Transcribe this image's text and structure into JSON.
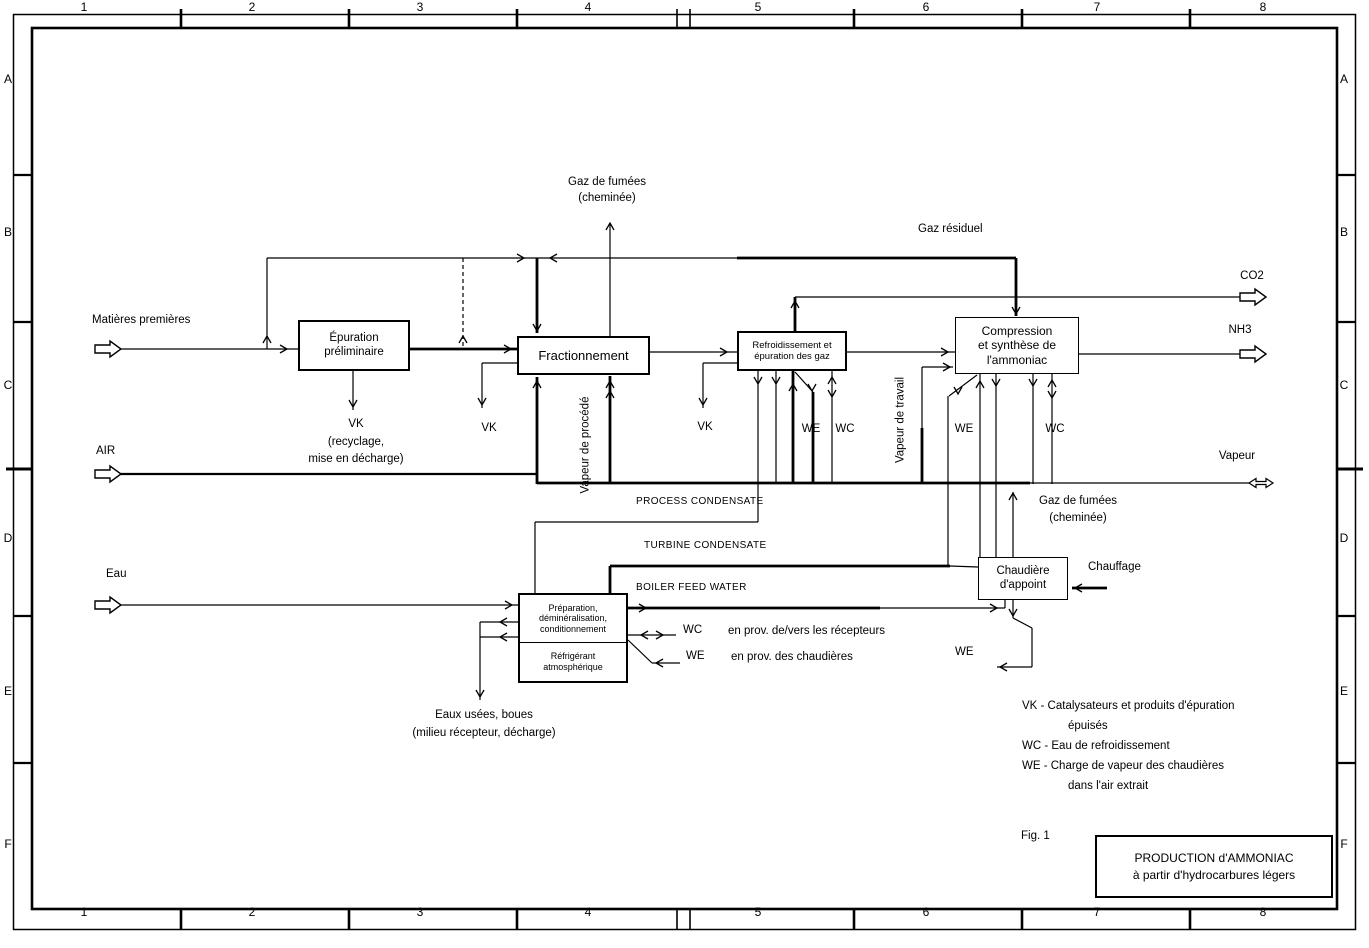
{
  "frame": {
    "columns": [
      "1",
      "2",
      "3",
      "4",
      "5",
      "6",
      "7",
      "8"
    ],
    "rows": [
      "A",
      "B",
      "C",
      "D",
      "E",
      "F"
    ]
  },
  "boxes": {
    "epuration": {
      "l1": "Épuration",
      "l2": "préliminaire"
    },
    "fractionnement": {
      "l1": "Fractionnement"
    },
    "refroidissement": {
      "l1": "Refroidissement et",
      "l2": "épuration des gaz"
    },
    "compression": {
      "l1": "Compression",
      "l2": "et synthèse de",
      "l3": "l'ammoniac"
    },
    "preparation": {
      "l1": "Préparation,",
      "l2": "déminéralisation,",
      "l3": "conditionnement"
    },
    "refrigerant": {
      "l1": "Réfrigérant",
      "l2": "atmosphérique"
    },
    "chaudiere": {
      "l1": "Chaudière",
      "l2": "d'appoint"
    }
  },
  "streams": {
    "matieres": "Matières premières",
    "air": "AIR",
    "eau": "Eau",
    "co2": "CO2",
    "nh3": "NH3",
    "vapeur": "Vapeur",
    "gaz_fumees_1": "Gaz de fumées",
    "gaz_fumees_2": "(cheminée)",
    "gaz_residuel": "Gaz résiduel",
    "vk": "VK",
    "we": "WE",
    "wc": "WC",
    "recyclage_1": "(recyclage,",
    "recyclage_2": "mise en décharge)",
    "vapeur_procede": "Vapeur de procédé",
    "vapeur_travail": "Vapeur de travail",
    "process_condensate": "PROCESS CONDENSATE",
    "turbine_condensate": "TURBINE CONDENSATE",
    "boiler_feed_water": "BOILER FEED WATER",
    "wc_recepteurs": "en prov. de/vers les récepteurs",
    "we_chaudieres": "en prov. des chaudières",
    "chauffage": "Chauffage",
    "eaux_usees_1": "Eaux usées, boues",
    "eaux_usees_2": "(milieu récepteur, décharge)"
  },
  "legend": {
    "vk_line1": "VK - Catalysateurs et produits d'épuration",
    "vk_line2": "épuisés",
    "wc_line": "WC - Eau de refroidissement",
    "we_line1": "WE - Charge de vapeur des chaudières",
    "we_line2": "dans l'air extrait"
  },
  "figure_label": "Fig. 1",
  "title_block": {
    "l1": "PRODUCTION d'AMMONIAC",
    "l2": "à partir d'hydrocarbures légers"
  },
  "colors": {
    "ink": "#000000",
    "paper": "#ffffff"
  }
}
